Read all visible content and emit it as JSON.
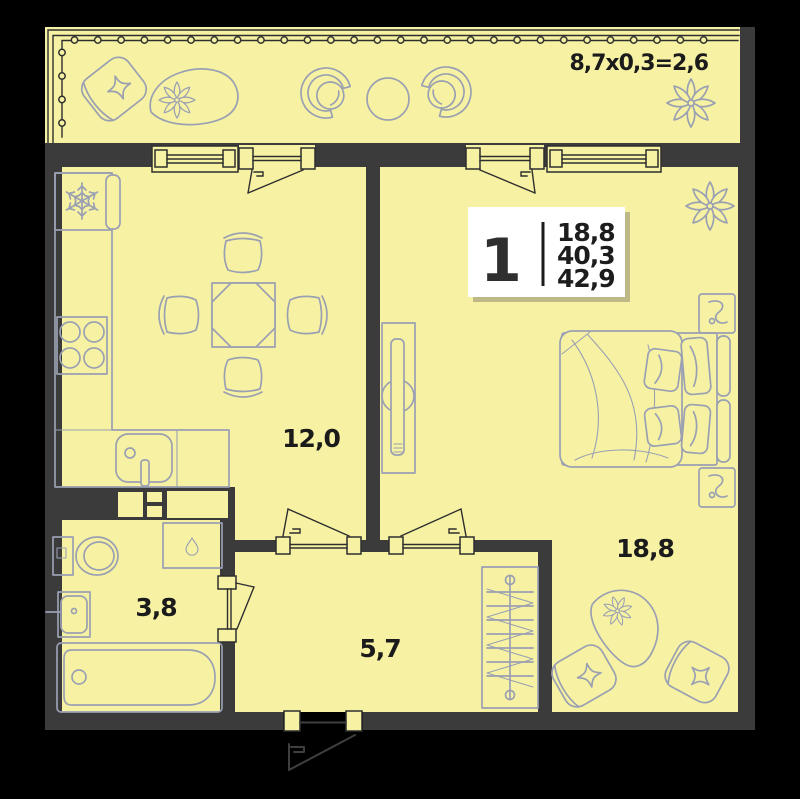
{
  "plan": {
    "type": "apartment-floor-plan",
    "balcony_label": "8,7x0,3=2,6",
    "info_box": {
      "room_count": "1",
      "area_values": [
        "18,8",
        "40,3",
        "42,9"
      ]
    },
    "room_labels": {
      "kitchen_living": "12,0",
      "bedroom": "18,8",
      "bathroom": "3,8",
      "hallway": "5,7"
    },
    "icons": {
      "fridge": "snowflake-icon",
      "washing_machine": "water-drop-icon",
      "plants": "flower-icon",
      "wardrobe": "hanger-rail-icon"
    },
    "colors": {
      "background": "#000000",
      "walls": "#3b3b3c",
      "floor": "#f7f2a3",
      "furniture_outline": "#9aa0b2",
      "detail_lines": "#2e2e2e",
      "label_text": "#1b1b1b",
      "info_box_background": "#ffffff",
      "info_box_shadow": "#b3ae80"
    }
  }
}
